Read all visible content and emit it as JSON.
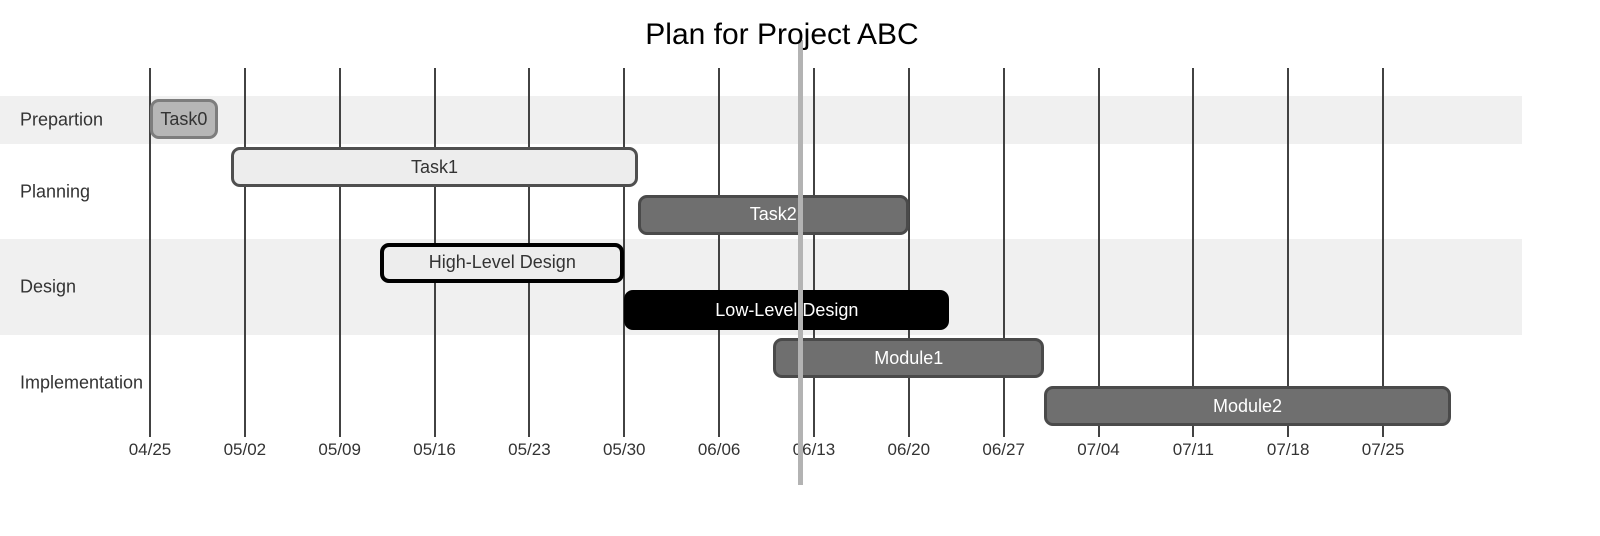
{
  "chart_data": {
    "type": "gantt",
    "title": "Plan for Project ABC",
    "today_marker": "06/12",
    "x_axis": {
      "interval": "1 week",
      "tick_labels": [
        "04/25",
        "05/02",
        "05/09",
        "05/16",
        "05/23",
        "05/30",
        "06/06",
        "06/13",
        "06/20",
        "06/27",
        "07/04",
        "07/11",
        "07/18",
        "07/25"
      ]
    },
    "sections": [
      {
        "label": "Prepartion",
        "shaded": true,
        "tasks": [
          {
            "label": "Task0",
            "start": "04/25",
            "end": "04/30",
            "style": "done"
          }
        ]
      },
      {
        "label": "Planning",
        "shaded": false,
        "tasks": [
          {
            "label": "Task1",
            "start": "05/01",
            "end": "05/31",
            "style": "light"
          },
          {
            "label": "Task2",
            "start": "05/31",
            "end": "06/20",
            "style": "dark"
          }
        ]
      },
      {
        "label": "Design",
        "shaded": true,
        "tasks": [
          {
            "label": "High-Level Design",
            "start": "05/12",
            "end": "05/30",
            "style": "outlined"
          },
          {
            "label": "Low-Level Design",
            "start": "05/30",
            "end": "06/23",
            "style": "black"
          }
        ]
      },
      {
        "label": "Implementation",
        "shaded": false,
        "tasks": [
          {
            "label": "Module1",
            "start": "06/10",
            "end": "06/30",
            "style": "dark"
          },
          {
            "label": "Module2",
            "start": "06/30",
            "end": "07/30",
            "style": "dark"
          }
        ]
      }
    ],
    "styles": {
      "done": {
        "fill": "#b6b6b6",
        "stroke": "#7d7d7d",
        "text": "#333333",
        "stroke_width": 3
      },
      "light": {
        "fill": "#ededed",
        "stroke": "#4f4f4f",
        "text": "#333333",
        "stroke_width": 3
      },
      "dark": {
        "fill": "#6f6f6f",
        "stroke": "#4a4a4a",
        "text": "#ffffff",
        "stroke_width": 3
      },
      "outlined": {
        "fill": "#ededed",
        "stroke": "#000000",
        "text": "#333333",
        "stroke_width": 4
      },
      "black": {
        "fill": "#000000",
        "stroke": "#000000",
        "text": "#ffffff",
        "stroke_width": 0
      }
    },
    "colors": {
      "band_shade": "#f0f0f0",
      "grid_line": "#424242",
      "today_line": "#b3b3b3",
      "axis_text": "#333333",
      "section_text": "#333333",
      "title_text": "#000000"
    }
  }
}
